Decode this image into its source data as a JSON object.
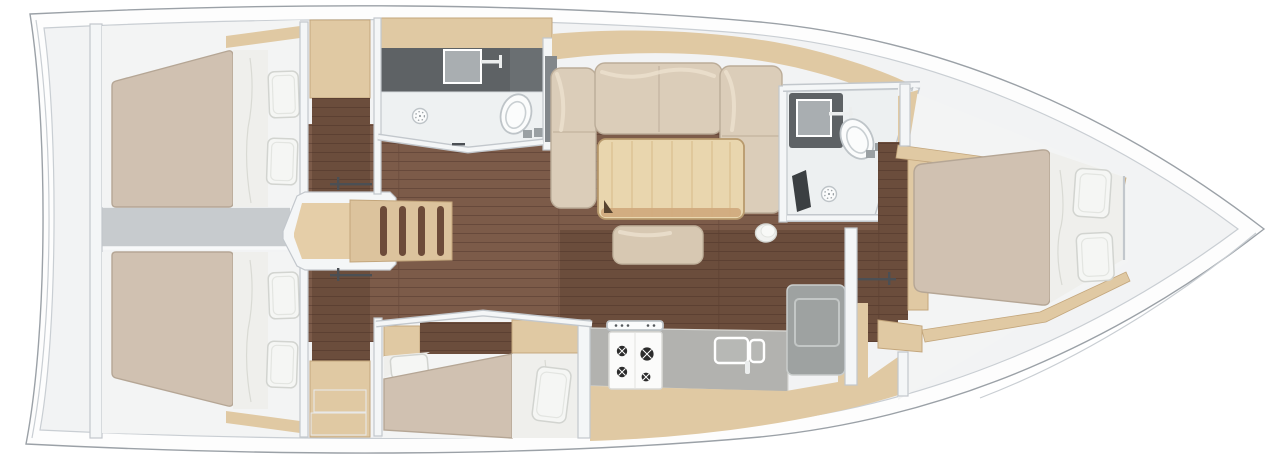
{
  "diagram": {
    "type": "yacht-interior-floor-plan",
    "view": "top-down",
    "orientation": {
      "bow": "right",
      "stern": "left"
    },
    "rooms": [
      {
        "name": "aft-port-cabin",
        "fixtures": [
          "double-berth",
          "pillow",
          "pillow",
          "wardrobe",
          "hull-shelf"
        ]
      },
      {
        "name": "aft-starboard-cabin",
        "fixtures": [
          "double-berth",
          "pillow",
          "pillow",
          "wardrobe",
          "hull-shelf"
        ]
      },
      {
        "name": "companionway",
        "fixtures": [
          "landing",
          "steps",
          "cabin-door-handle",
          "cabin-door-handle"
        ]
      },
      {
        "name": "engine-compartment",
        "fixtures": []
      },
      {
        "name": "aft-head",
        "fixtures": [
          "vanity-counter",
          "sink",
          "faucet",
          "shower-drain",
          "toilet"
        ]
      },
      {
        "name": "salon",
        "fixtures": [
          "u-shaped-sofa",
          "dining-table",
          "ottoman",
          "stool",
          "hull-sideboard"
        ]
      },
      {
        "name": "forward-head",
        "fixtures": [
          "sink",
          "faucet",
          "toilet",
          "shower-drain",
          "shower-seat"
        ]
      },
      {
        "name": "galley",
        "fixtures": [
          "countertop",
          "stove-4-burners",
          "double-sink",
          "top-loading-fridge",
          "cabinet-front"
        ]
      },
      {
        "name": "mid-cabin",
        "fixtures": [
          "berth",
          "pillow",
          "berth",
          "pillow",
          "cabinets"
        ]
      },
      {
        "name": "forward-cabin",
        "fixtures": [
          "island-double-berth",
          "pillow",
          "pillow",
          "side-shelf",
          "door",
          "door-handle"
        ]
      }
    ]
  },
  "palette": {
    "deck": "#fdfdfd",
    "hullLine": "#9ba1a7",
    "hullLineSoft": "#c9ced3",
    "base": "#f2f3f4",
    "roomWhite": "#f3f4f4",
    "wall": "#f4f6f7",
    "wallEdge": "#c2c7cc",
    "floor": "#7c5b49",
    "floorLine": "#67493b",
    "floorShade": "#3f2a1e",
    "wood": "#e0c9a3",
    "woodEdge": "#c3a67c",
    "mattress": "#d0c1b1",
    "mattressEdge": "#b5a695",
    "sheet": "#efefec",
    "sheetLine": "#d9dad4",
    "pillow": "#f5f6f4",
    "pillowEdge": "#d2d4d0",
    "sofa": "#dbcdb9",
    "sofaEdge": "#bbac98",
    "sofaHighlight": "#ebdfcd",
    "table": "#e9d6ae",
    "tableEdge": "#b89a6d",
    "tableGrain": "#d9bd8d",
    "tableSide": "#cfa97c",
    "tableNotch": "#57432f",
    "ottoman": "#d7c8b2",
    "ottomanEdge": "#c0b19b",
    "counterDark": "#5e6265",
    "counterGray": "#b2b2af",
    "counterEdge": "#d8d8d4",
    "fridge": "#9ea2a1",
    "fridgeEdge": "#c9cdcc",
    "fixture": "#fbfcfc",
    "fixtureEdge": "#bec4c8",
    "sinkGray": "#a9aeb1",
    "faucet": "#eceeee",
    "burner": "#2c2c2c",
    "seatDark": "#3b3f42",
    "handle": "#4b4f54",
    "stepWood": "#dcc39d",
    "stepSlot": "#6d4b39",
    "landing": "#e5cea8",
    "engine": "#c7cbce",
    "panelGray": "#82878b",
    "drainDot": "#9aa1a5",
    "stoveBody": "#fbfbfa",
    "stoveEdge": "#d9d9d6"
  }
}
